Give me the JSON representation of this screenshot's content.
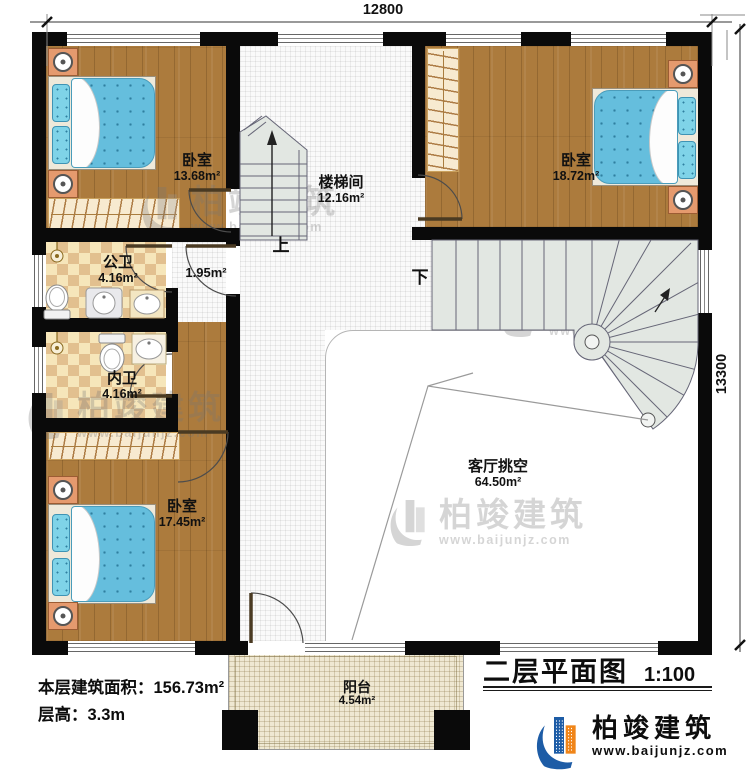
{
  "dimensions": {
    "top_width": "12800",
    "right_height": "13300"
  },
  "rooms": {
    "bedroom_top_left": {
      "name": "卧室",
      "area": "13.68m²"
    },
    "stair_hall": {
      "name": "楼梯间",
      "area": "12.16m²"
    },
    "bedroom_top_right": {
      "name": "卧室",
      "area": "18.72m²"
    },
    "public_bath": {
      "name": "公卫",
      "area": "4.16m²"
    },
    "hallway": {
      "area": "1.95m²"
    },
    "private_bath": {
      "name": "内卫",
      "area": "4.16m²"
    },
    "bedroom_bottom_left": {
      "name": "卧室",
      "area": "17.45m²"
    },
    "living_void": {
      "name": "客厅挑空",
      "area": "64.50m²"
    },
    "balcony": {
      "name": "阳台",
      "area": "4.54m²"
    }
  },
  "stairs": {
    "up_label": "上",
    "down_label": "下"
  },
  "footer": {
    "floor_area": "本层建筑面积：156.73m²",
    "floor_height": "层高：3.3m",
    "plan_title": "二层平面图",
    "plan_scale": "1:100"
  },
  "brand": {
    "name": "柏竣建筑",
    "website": "www.baijunjz.com"
  },
  "colors": {
    "wall": "#0a0a0a",
    "wood_floor": "#ac7b3d",
    "bath_tile_light": "#f6e6ba",
    "bath_tile_dark": "#e2c08f",
    "bed": "#65bedd",
    "nightstand": "#e59a6e",
    "stair_tread": "#e2e7e2",
    "balcony_floor": "#efe8d2",
    "brand_blue": "#1d5ca6",
    "brand_orange": "#f08519"
  }
}
